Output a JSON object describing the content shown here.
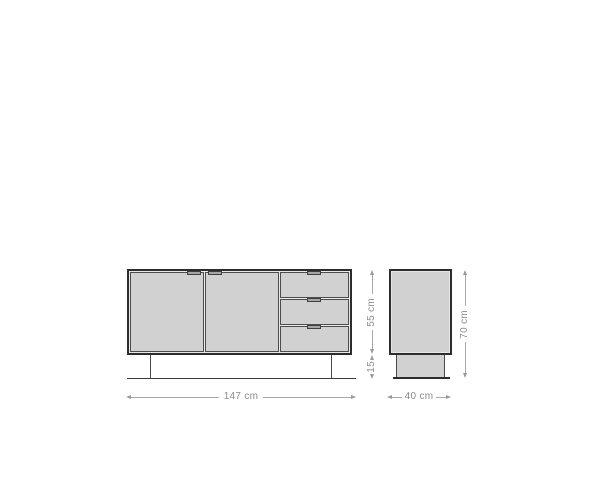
{
  "drawing": {
    "name": "Sideboard dimension drawing",
    "front_view": {
      "doors": 2,
      "drawers": 3,
      "width_label": "147 cm",
      "body_height_label": "55 cm",
      "base_height_label": "15",
      "width_cm": 147,
      "body_height_cm": 55,
      "base_height_cm": 15
    },
    "side_view": {
      "depth_label": "40 cm",
      "total_height_label": "70 cm",
      "depth_cm": 40,
      "total_height_cm": 70
    },
    "colors": {
      "panel_fill": "#d1d1d1",
      "outline_dark": "#2d2d2d",
      "panel_border": "#4d4d4d",
      "handle_fill": "#a6a6a6",
      "dimension_line": "#a8a8a8",
      "dimension_text": "#8c8c8c",
      "background": "#ffffff"
    }
  }
}
